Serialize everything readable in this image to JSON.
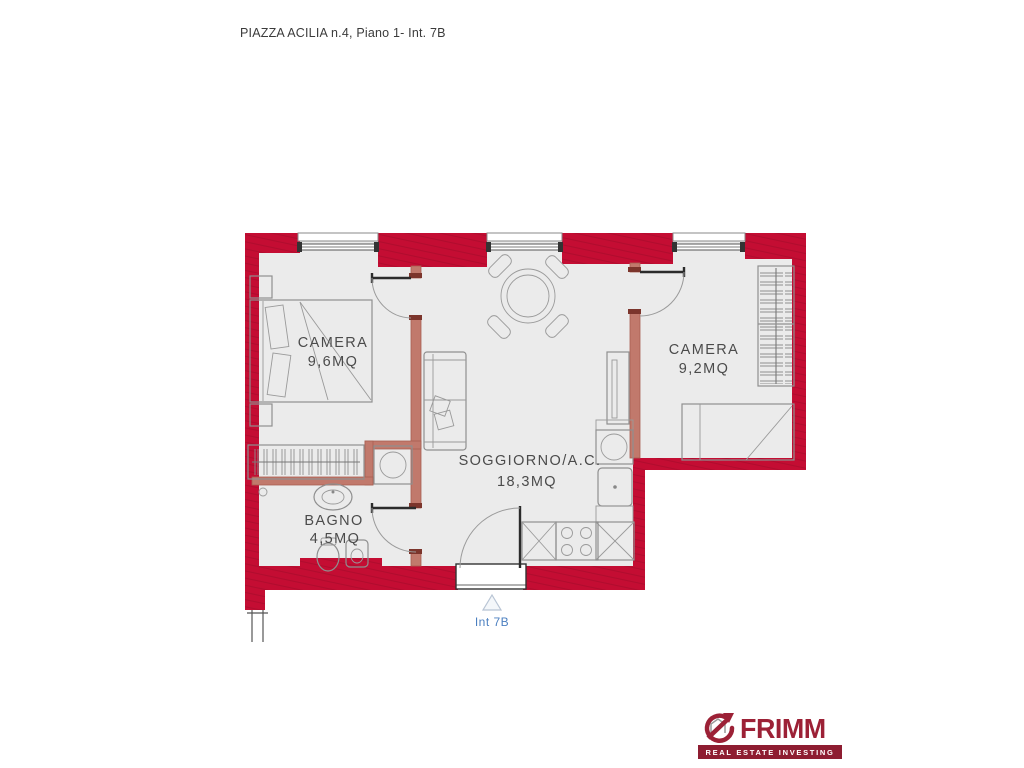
{
  "title": "PIAZZA ACILIA n.4, Piano 1- Int. 7B",
  "rooms": [
    {
      "name": "CAMERA",
      "area": "9,6MQ"
    },
    {
      "name": "SOGGIORNO/A.C.",
      "area": "18,3MQ"
    },
    {
      "name": "CAMERA",
      "area": "9,2MQ"
    },
    {
      "name": "BAGNO",
      "area": "4,5MQ"
    }
  ],
  "entrance": {
    "label": "Int 7B",
    "marker": "triangle-up-icon"
  },
  "logo": {
    "brand": "FRIMM",
    "tagline": "REAL ESTATE INVESTING"
  },
  "colors": {
    "wall": "#c40d33",
    "partition": "#c1796c",
    "floor": "#ebebeb",
    "entrance_text": "#4b7fc0",
    "brand": "#9c2136",
    "banner": "#8e1d31"
  }
}
